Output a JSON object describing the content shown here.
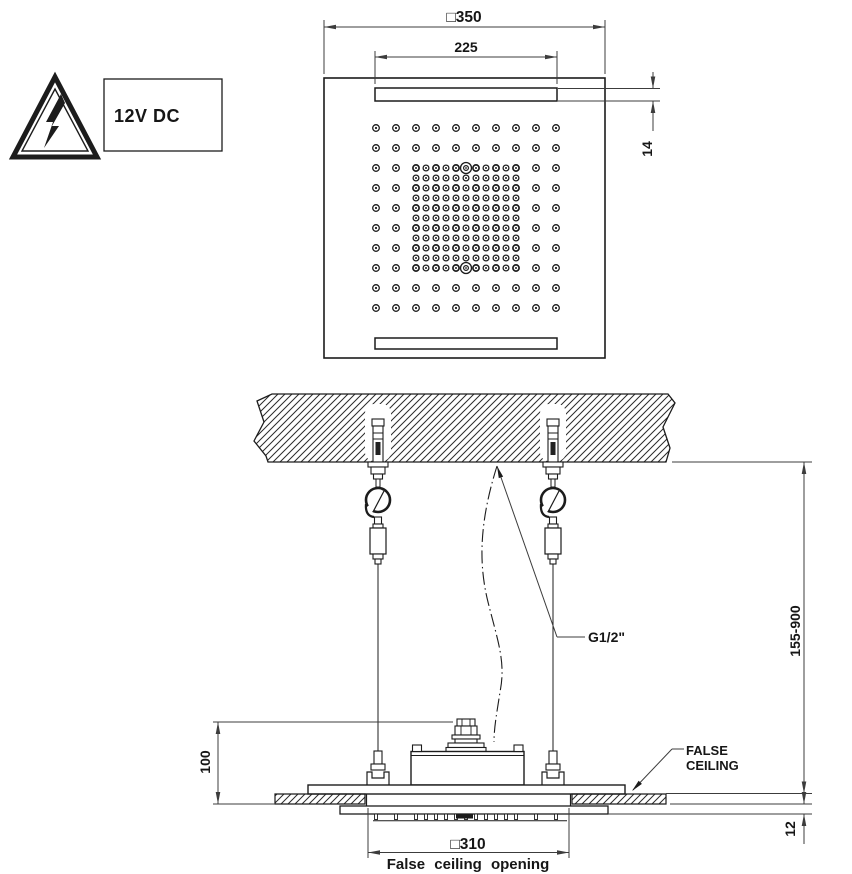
{
  "sign": {
    "voltage_label": "12V DC"
  },
  "top_view": {
    "dim_overall_width": "□350",
    "dim_inner_width": "225",
    "dim_slot_height": "14",
    "nozzle_pattern": {
      "outer_grid": {
        "cols": 10,
        "rows": 10,
        "x0": 376,
        "y0": 128,
        "spacing": 20
      },
      "inner_grid": {
        "cols": 11,
        "rows": 11,
        "x0": 416,
        "y0": 168,
        "spacing": 10
      },
      "special_nozzles": [
        {
          "x": 466,
          "y": 168
        },
        {
          "x": 466,
          "y": 268
        }
      ]
    }
  },
  "side_view": {
    "dim_height_adjust_range": "155-900",
    "dim_head_height": "100",
    "dim_protrusion": "12",
    "dim_opening_width": "□310",
    "opening_caption": "False ceiling opening",
    "connection_label": "G1/2\"",
    "false_ceiling_label_line1": "FALSE",
    "false_ceiling_label_line2": "CEILING"
  }
}
